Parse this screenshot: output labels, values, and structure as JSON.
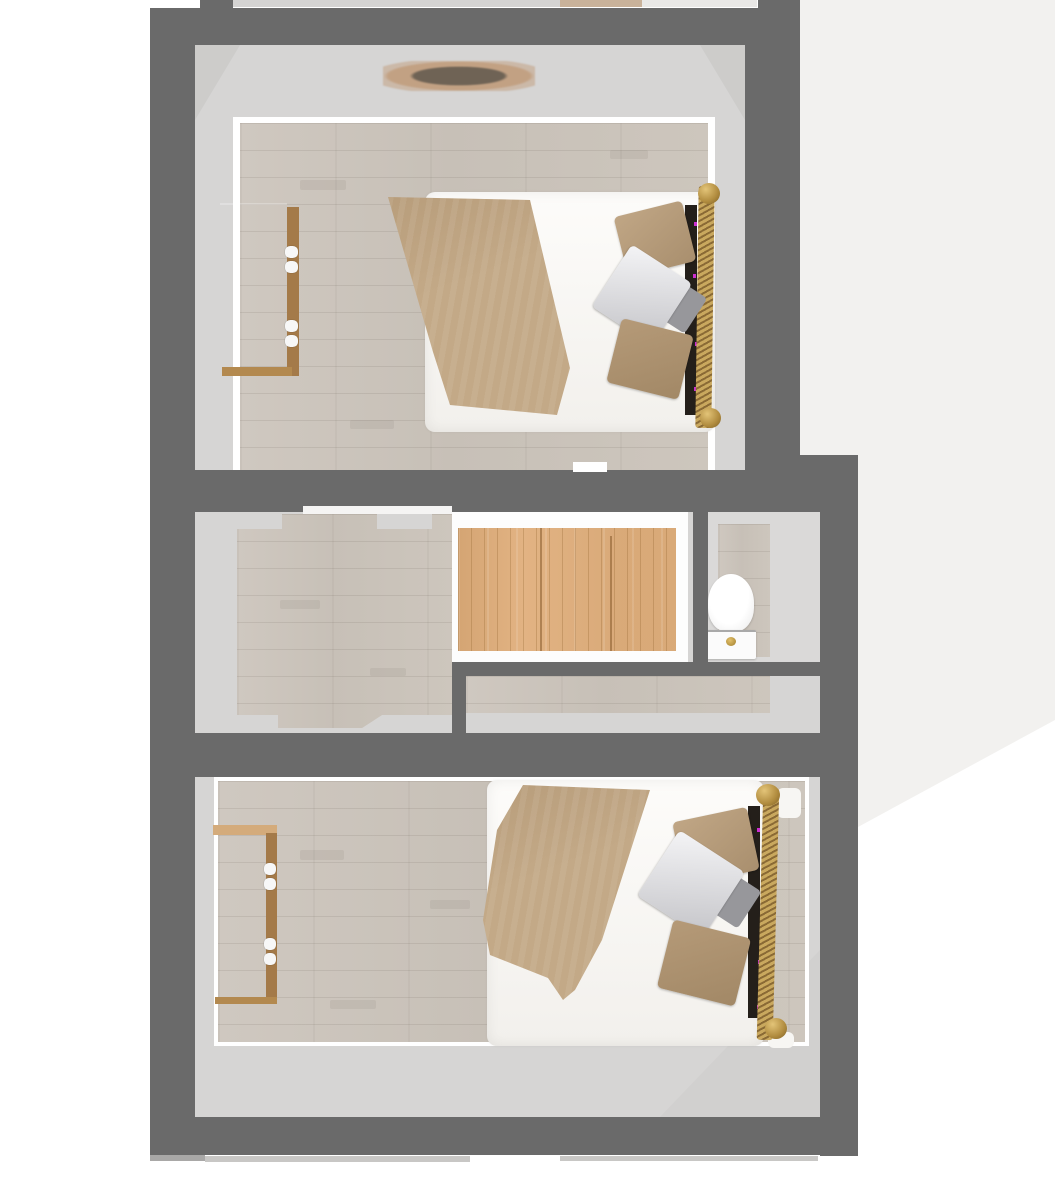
{
  "scene": {
    "kind": "floor-plan-3d-render",
    "view": "top-down",
    "description": "Upper floor plan with two bedrooms, a landing with stair opening, and a small WC",
    "rooms": [
      {
        "id": "bedroom-top",
        "label": "Bedroom (top)",
        "furniture": [
          "double-bed",
          "wardrobe",
          "ceiling-light"
        ]
      },
      {
        "id": "hallway",
        "label": "Landing / hallway",
        "furniture": [
          "stair-opening-runner"
        ]
      },
      {
        "id": "wc",
        "label": "WC",
        "furniture": [
          "toilet"
        ]
      },
      {
        "id": "bedroom-bottom",
        "label": "Bedroom (bottom)",
        "furniture": [
          "double-bed",
          "wardrobe"
        ]
      }
    ],
    "furniture_counts": {
      "beds": 2,
      "wardrobes": 2,
      "toilets": 1,
      "ceiling_lights": 1,
      "stair_runners": 1
    }
  },
  "colors": {
    "wall": "#6a6a6a",
    "interior_margin": "#d6d5d4",
    "wood_floor": "#ccc5bc",
    "stair_runner": "#e2b383",
    "stringer_white": "#fdfdfd",
    "blanket": "#c3a987",
    "pillow_tan": "#b49a79",
    "pillow_white": "#e9e9eb",
    "wardrobe_wood": "#c59c6c",
    "wardrobe_side": "#a47a49",
    "bed_rail_brass": "#c9a85e",
    "rail_accent_magenta": "#cc2fd0",
    "toilet_white": "#fbfbfb",
    "flush_button_gold": "#c9a23f",
    "background_right": "#f2f1ef",
    "background": "#ffffff"
  }
}
